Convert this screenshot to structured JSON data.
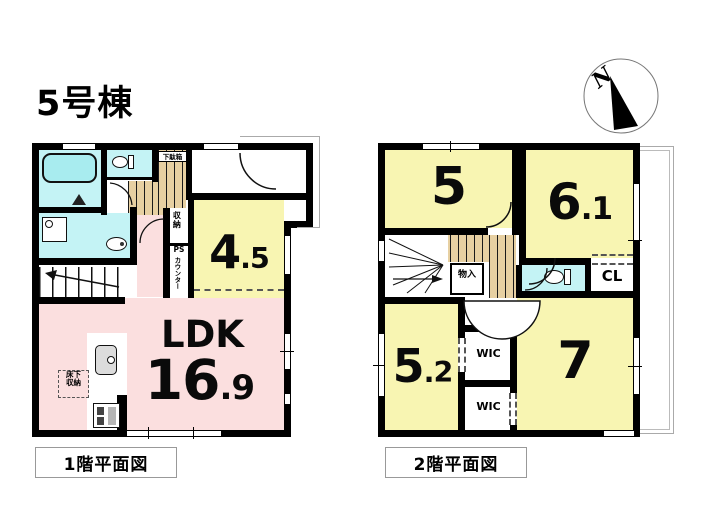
{
  "title": "5号棟",
  "compass": {
    "label": "N"
  },
  "floor1": {
    "caption": "1階平面図",
    "ldk": {
      "label": "LDK",
      "num": "16",
      "frac": ".9"
    },
    "room45": {
      "num": "4",
      "frac": ".5"
    },
    "labels": {
      "getabako": "下駄箱",
      "shunou": "収納",
      "ps": "PS",
      "counter": "カウンター",
      "yukashita1": "床下",
      "yukashita2": "収納"
    }
  },
  "floor2": {
    "caption": "2階平面図",
    "room5": {
      "num": "5"
    },
    "room61": {
      "num": "6",
      "frac": ".1"
    },
    "room52": {
      "num": "5",
      "frac": ".2"
    },
    "room7": {
      "num": "7"
    },
    "labels": {
      "monoire": "物入",
      "cl": "CL",
      "wic_upper": "WIC",
      "wic_lower": "WIC"
    }
  },
  "colors": {
    "wall": "#000000",
    "room_yellow": "#f8f5b2",
    "ldk_pink": "#fbdfdf",
    "wet_cyan": "#c4f3f5",
    "hall_tan": "#e7d0a2",
    "fixture_gray": "#dcdcdc"
  }
}
